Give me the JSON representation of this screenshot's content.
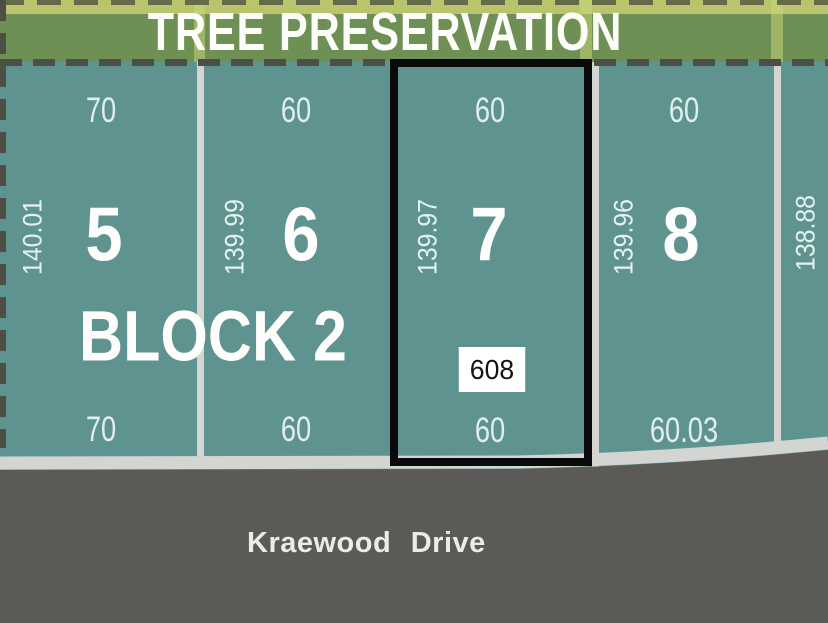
{
  "banner": {
    "title": "TREE PRESERVATION"
  },
  "block": {
    "label": "BLOCK 2"
  },
  "lots": [
    {
      "number": "5",
      "width_top": "70",
      "depth": "140.01",
      "width_bottom": "70"
    },
    {
      "number": "6",
      "width_top": "60",
      "depth": "139.99",
      "width_bottom": "60"
    },
    {
      "number": "7",
      "width_top": "60",
      "depth": "139.97",
      "width_bottom": "60",
      "parcel_tag": "608",
      "highlighted": true
    },
    {
      "number": "8",
      "width_top": "60",
      "depth": "139.96",
      "width_bottom": "60.03"
    }
  ],
  "right_boundary_depth": "138.88",
  "street": {
    "name": "Kraewood Drive"
  },
  "colors": {
    "lot_fill": "#5f9390",
    "tree_band": "#6e9055",
    "tree_band_light": "#b9c46c",
    "divider": "#d2d5d2",
    "curb": "#d2d5d2",
    "road": "#5c5a57",
    "highlight_border": "#0a0a0a",
    "boundary_dash": "#4b4f45",
    "tag_background": "#ffffff"
  }
}
